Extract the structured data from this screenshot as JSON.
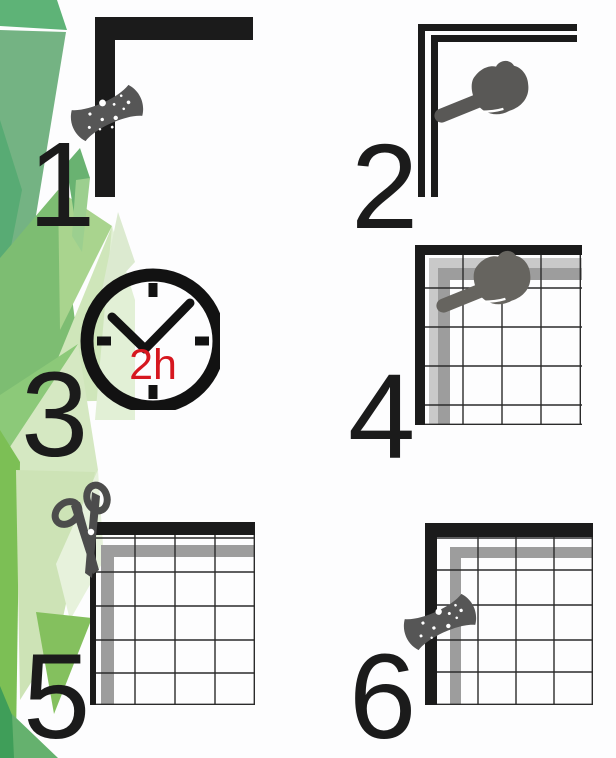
{
  "figure": {
    "type": "installation-instruction-steps",
    "background": "#ffffff"
  },
  "palette": {
    "ink": "#1b1b1b",
    "tool_gray": "#595856",
    "hand_gray_light": "#66645f",
    "tape_gray": "#9d9d9d",
    "tape_gray_light": "#c9c9c9",
    "scissors_gray": "#4c4c4c",
    "accent_red": "#d6171f",
    "greens": [
      "#5eb377",
      "#74b383",
      "#7dbd72",
      "#cfe6ba",
      "#a9d48e",
      "#8cc979",
      "#d5e8c2",
      "#7cbf55",
      "#cde3b6",
      "#84c05e",
      "#3f9e59",
      "#65b16e"
    ]
  },
  "steps": [
    {
      "number": "1",
      "icons": [
        "frame-corner-icon",
        "sponge-icon"
      ]
    },
    {
      "number": "2",
      "icons": [
        "frame-corner-taped-icon",
        "pressing-hand-icon"
      ]
    },
    {
      "number": "3",
      "icons": [
        "clock-icon"
      ],
      "label": "2h"
    },
    {
      "number": "4",
      "icons": [
        "mesh-on-frame-icon",
        "pressing-hand-icon"
      ]
    },
    {
      "number": "5",
      "icons": [
        "mesh-on-frame-icon",
        "scissors-icon"
      ]
    },
    {
      "number": "6",
      "icons": [
        "mesh-on-frame-icon",
        "sponge-icon"
      ]
    }
  ]
}
